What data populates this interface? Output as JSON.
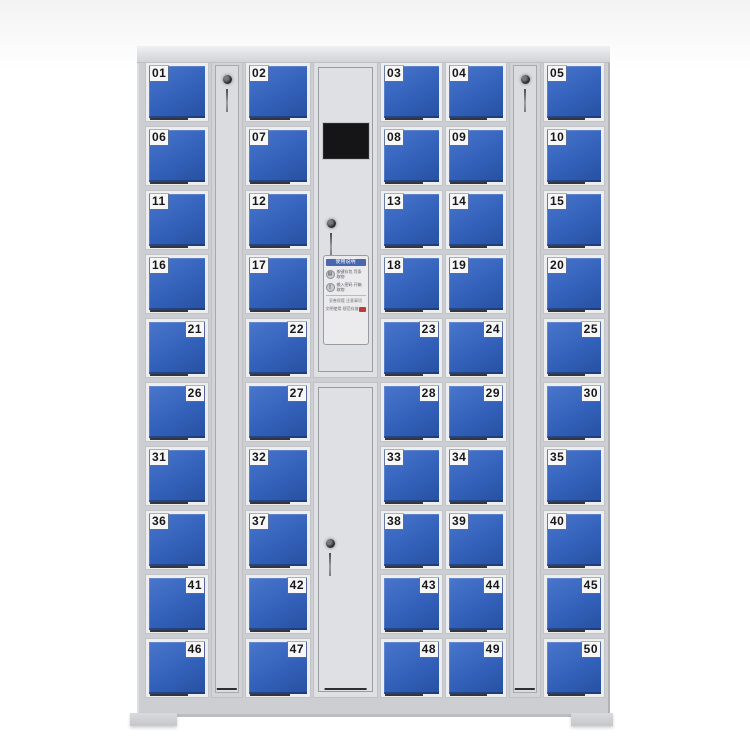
{
  "scene": {
    "description": "electronic storage locker cabinet with 50 numbered blue doors",
    "background_color": "#ffffff"
  },
  "cabinet": {
    "body_color": "#cdced2",
    "door_color": "#3361ba",
    "frame_color": "#edeef0",
    "label_bg": "#f7f7f8",
    "label_text_color": "#17171a",
    "columns": [
      {
        "name": "column-1",
        "label_side": "left",
        "doors": [
          "01",
          "02",
          "03",
          "04",
          "05",
          "06",
          "07",
          "08",
          "09",
          "10"
        ]
      },
      {
        "name": "column-2",
        "label_side": "left",
        "doors": [
          "11",
          "12",
          "13",
          "14",
          "15",
          "16",
          "17",
          "18",
          "19",
          "20"
        ]
      },
      {
        "name": "column-3",
        "label_side": "right",
        "doors": [
          "21",
          "22",
          "23",
          "24",
          "25",
          "26",
          "27",
          "28",
          "29",
          "30"
        ]
      },
      {
        "name": "column-4",
        "label_side": "left",
        "doors": [
          "31",
          "32",
          "33",
          "34",
          "35",
          "36",
          "37",
          "38",
          "39",
          "40"
        ]
      },
      {
        "name": "column-5",
        "label_side": "right",
        "doors": [
          "41",
          "42",
          "43",
          "44",
          "45",
          "46",
          "47",
          "48",
          "49",
          "50"
        ]
      }
    ],
    "side_panels": [
      {
        "name": "left-key-panel",
        "has_key": true
      },
      {
        "name": "right-key-panel",
        "has_key": true
      }
    ],
    "control_panel": {
      "screen_color": "#151517",
      "sticker": {
        "title": "使用说明",
        "steps": [
          {
            "icon": "keypad-icon",
            "text": "按键存包 凭条取物"
          },
          {
            "icon": "door-icon",
            "text": "输入密码 开箱取物"
          }
        ],
        "note": "妥善保管 注意事项",
        "footer": "文明使用 规范存放",
        "header_color": "#4a66b0",
        "accent_color": "#c23a34"
      }
    }
  }
}
